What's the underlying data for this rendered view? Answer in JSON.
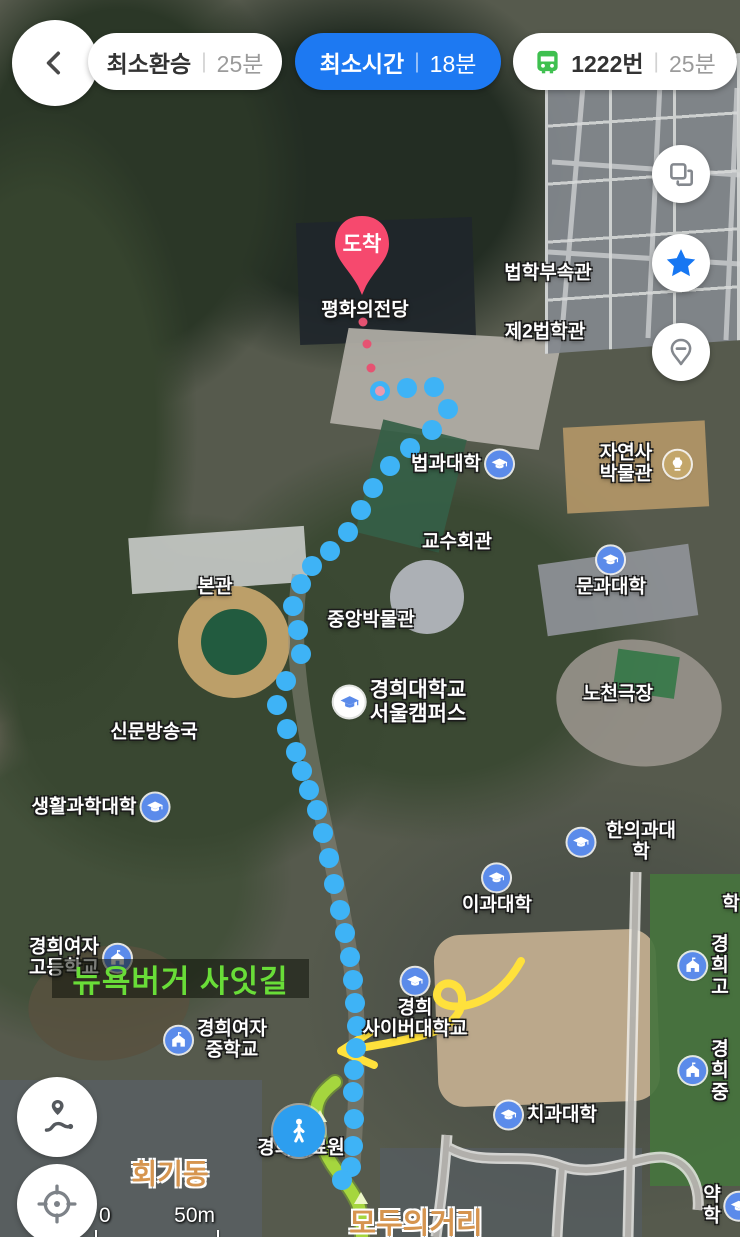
{
  "header": {
    "routes": [
      {
        "label": "최소환승",
        "time": "25분",
        "selected": false,
        "bus": false,
        "x": 88,
        "w": 194
      },
      {
        "label": "최소시간",
        "time": "18분",
        "selected": true,
        "bus": false,
        "x": 295,
        "w": 206
      },
      {
        "label": "1222번",
        "time": "25분",
        "selected": false,
        "bus": true,
        "x": 513,
        "w": 224
      }
    ],
    "divider": "|"
  },
  "pin": {
    "label": "도착",
    "color": "#f6496e"
  },
  "walker": {
    "icon": "walking-person"
  },
  "note": {
    "text": "뉴욕버거 사잇길",
    "x": 52,
    "y": 959,
    "w": 257,
    "h": 39
  },
  "scale": {
    "zero": "0",
    "dist": "50m"
  },
  "labels": [
    {
      "text": "평화의전당",
      "x": 365,
      "y": 310,
      "kind": "place"
    },
    {
      "text": "법학부속관",
      "x": 548,
      "y": 273,
      "kind": "place"
    },
    {
      "text": "제2법학관",
      "x": 545,
      "y": 332,
      "kind": "place"
    },
    {
      "text": "법과대학",
      "x": 462,
      "y": 464,
      "kind": "place",
      "icon": "college",
      "icon_pos": "right"
    },
    {
      "text": "자연사박물관",
      "x": 642,
      "y": 464,
      "kind": "place",
      "icon": "museum",
      "icon_pos": "right"
    },
    {
      "text": "교수회관",
      "x": 457,
      "y": 542,
      "kind": "place"
    },
    {
      "text": "문과대학",
      "x": 611,
      "y": 572,
      "kind": "place",
      "icon": "college",
      "icon_pos": "above"
    },
    {
      "text": "본관",
      "x": 215,
      "y": 587,
      "kind": "place"
    },
    {
      "text": "중앙박물관",
      "x": 371,
      "y": 620,
      "kind": "place"
    },
    {
      "text": "경희대학교\n서울캠퍼스",
      "x": 400,
      "y": 702,
      "kind": "place-lg",
      "icon": "college-lg",
      "icon_pos": "left"
    },
    {
      "text": "노천극장",
      "x": 618,
      "y": 694,
      "kind": "place"
    },
    {
      "text": "신문방송국",
      "x": 154,
      "y": 732,
      "kind": "place"
    },
    {
      "text": "생활과학대학",
      "x": 100,
      "y": 807,
      "kind": "place",
      "icon": "college",
      "icon_pos": "right"
    },
    {
      "text": "한의과대학",
      "x": 625,
      "y": 842,
      "kind": "place",
      "icon": "college",
      "icon_pos": "left"
    },
    {
      "text": "이과대학",
      "x": 497,
      "y": 890,
      "kind": "place",
      "icon": "college",
      "icon_pos": "above"
    },
    {
      "text": "학",
      "x": 731,
      "y": 904,
      "kind": "place"
    },
    {
      "text": "경희여자\n고등학교",
      "x": 80,
      "y": 958,
      "kind": "place",
      "icon": "school",
      "icon_pos": "right"
    },
    {
      "text": "경희고",
      "x": 704,
      "y": 966,
      "kind": "place",
      "icon": "school",
      "icon_pos": "left"
    },
    {
      "text": "경희여자\n중학교",
      "x": 216,
      "y": 1040,
      "kind": "place",
      "icon": "school",
      "icon_pos": "left"
    },
    {
      "text": "경희\n사이버대학교",
      "x": 415,
      "y": 1004,
      "kind": "place",
      "icon": "college",
      "icon_pos": "above"
    },
    {
      "text": "경희중",
      "x": 704,
      "y": 1071,
      "kind": "place",
      "icon": "school",
      "icon_pos": "left"
    },
    {
      "text": "치과대학",
      "x": 546,
      "y": 1115,
      "kind": "place",
      "icon": "college",
      "icon_pos": "left"
    },
    {
      "text": "경희의료원",
      "x": 301,
      "y": 1148,
      "kind": "place"
    },
    {
      "text": "회기동",
      "x": 170,
      "y": 1174,
      "kind": "district"
    },
    {
      "text": "약학",
      "x": 728,
      "y": 1206,
      "kind": "place",
      "icon": "college",
      "icon_pos": "right"
    },
    {
      "text": "모두의거리",
      "x": 416,
      "y": 1224,
      "kind": "district-lg"
    }
  ],
  "route": {
    "dot_color": "#3eb3f6",
    "start_dot": [
      380,
      391
    ],
    "dots": [
      [
        407,
        388
      ],
      [
        434,
        387
      ],
      [
        448,
        409
      ],
      [
        432,
        430
      ],
      [
        410,
        448
      ],
      [
        390,
        466
      ],
      [
        373,
        488
      ],
      [
        361,
        510
      ],
      [
        348,
        532
      ],
      [
        330,
        551
      ],
      [
        312,
        566
      ],
      [
        301,
        584
      ],
      [
        293,
        606
      ],
      [
        298,
        630
      ],
      [
        301,
        654
      ],
      [
        286,
        681
      ],
      [
        277,
        705
      ],
      [
        287,
        729
      ],
      [
        296,
        752
      ],
      [
        302,
        771
      ],
      [
        309,
        790
      ],
      [
        317,
        810
      ],
      [
        323,
        833
      ],
      [
        329,
        858
      ],
      [
        334,
        884
      ],
      [
        340,
        910
      ],
      [
        345,
        933
      ],
      [
        350,
        957
      ],
      [
        353,
        980
      ],
      [
        355,
        1003
      ],
      [
        357,
        1026
      ],
      [
        356,
        1048
      ],
      [
        354,
        1070
      ],
      [
        353,
        1092
      ],
      [
        354,
        1119
      ],
      [
        353,
        1146
      ],
      [
        351,
        1167
      ],
      [
        342,
        1180
      ]
    ],
    "pin_trail": [
      [
        363,
        322
      ],
      [
        367,
        344
      ],
      [
        371,
        368
      ]
    ],
    "walk_path": "M335,1082 C322,1092 316,1100 316,1114 C316,1132 322,1148 332,1164 C342,1179 352,1190 358,1204 C361,1212 362,1222 362,1236",
    "walk_color": "#a9da3e",
    "walk_edge": "#7fae2e",
    "chevrons": [
      [
        320,
        1117
      ],
      [
        361,
        1199
      ]
    ]
  },
  "arrow": {
    "color": "#ffe13c",
    "d": "M521,961 C506,988 486,1001 468,1005 C446,1010 433,1001 438,990 C443,979 461,982 462,998 C463,1016 446,1029 424,1035 C399,1042 372,1046 354,1049",
    "head": "M372,1031 L341,1051 L374,1065"
  },
  "icons": {
    "back": "chevron-left",
    "layers": "layers",
    "favorite": "star",
    "pin_minus": "pin-minus",
    "route_btn": "route",
    "my_location": "crosshair",
    "bus": "bus",
    "destination": "pin"
  }
}
